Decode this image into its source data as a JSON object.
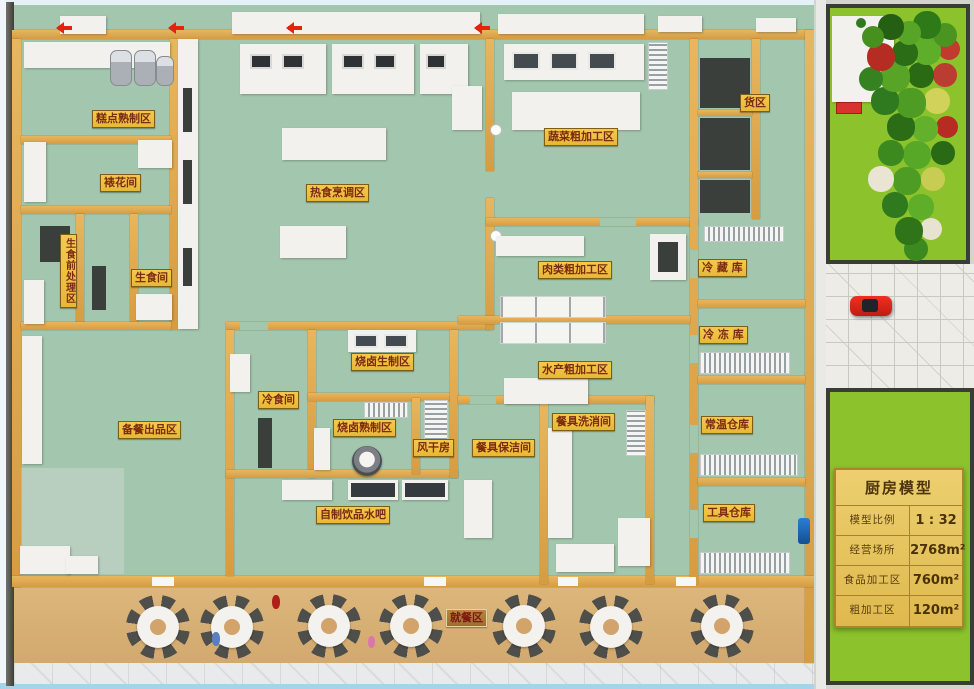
{
  "rooms": [
    {
      "name": "糕点熟制区"
    },
    {
      "name": "裱花间"
    },
    {
      "name": "生食前处理区"
    },
    {
      "name": "生食间"
    },
    {
      "name": "热食烹调区"
    },
    {
      "name": "蔬菜粗加工区"
    },
    {
      "name": "货区"
    },
    {
      "name": "肉类粗加工区"
    },
    {
      "name": "冷 藏 库"
    },
    {
      "name": "冷 冻 库"
    },
    {
      "name": "水产粗加工区"
    },
    {
      "name": "常温仓库"
    },
    {
      "name": "烧卤生制区"
    },
    {
      "name": "冷食间"
    },
    {
      "name": "烧卤熟制区"
    },
    {
      "name": "风干房"
    },
    {
      "name": "餐具保洁间"
    },
    {
      "name": "餐具洗消间"
    },
    {
      "name": "备餐出品区"
    },
    {
      "name": "自制饮品水吧"
    },
    {
      "name": "工具仓库"
    },
    {
      "name": "就餐区"
    }
  ],
  "sign": {
    "title": "厨房模型",
    "rows": [
      {
        "label": "模型比例",
        "value": "1 : 32"
      },
      {
        "label": "经营场所",
        "value": "2768m²"
      },
      {
        "label": "食品加工区",
        "value": "760m²"
      },
      {
        "label": "粗加工区",
        "value": "120m²"
      }
    ]
  },
  "colors": {
    "floor_green": "#a3c7ae",
    "wall_tan": "#dca84e",
    "label_yellow": "#f0c23e",
    "label_text": "#7c2a12",
    "dining_floor": "#d8b175",
    "lawn_green": "#8cc22c",
    "sign_gold": "#e7c45f",
    "car_red": "#e02418"
  }
}
